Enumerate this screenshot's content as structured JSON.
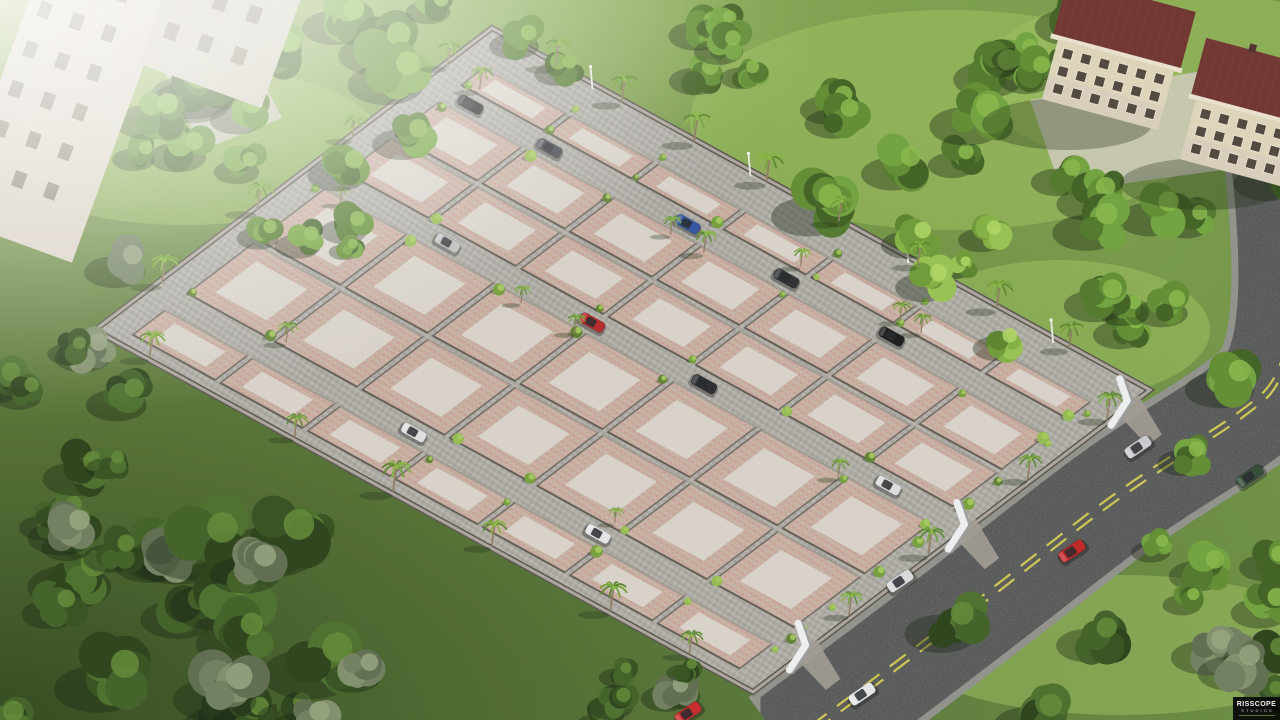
{
  "meta": {
    "type": "3d-aerial-render",
    "subject": "residential plot layout development"
  },
  "watermark": {
    "studio": "RISSCOPE",
    "subtitle": "STUDIOS"
  },
  "palette": {
    "grass": "#6c8f41",
    "grassDark": "#33491d",
    "grassLight": "#9cc05c",
    "plotPaver": [
      "#c9a89d",
      "#bfae9f",
      "#c2a195",
      "#cbb4a6"
    ],
    "plotCenter": "#d8d4cd",
    "roadPaver": [
      "#a8a6a0",
      "#b3b1ab",
      "#9f9d97",
      "#aeaca6"
    ],
    "wallLine": "#6e6963",
    "wallShadow": "#4e4a44",
    "wallLight": "#cfc9c0",
    "boundaryDark": "#55514a",
    "boundaryLight": "#a8a29a",
    "asphalt": "#474849",
    "curb": "#8e8e88",
    "laneLine": "#d8d24e",
    "gateWhite": "#eceef0",
    "gateShadow": "#97999b",
    "roof": "#6b2f2b",
    "roofStripe": "#7b3833",
    "buildingWall": "#dcd3b8",
    "buildingWallShade": "#cfc8ba",
    "windowDark": "#4a4238",
    "windowFrame": "#ece4d0",
    "trunk": "#8a7a5e",
    "haze": "#ffffff"
  },
  "site": {
    "corners": {
      "top": [
        492,
        28
      ],
      "right": [
        1150,
        390
      ],
      "bottom": [
        753,
        692
      ],
      "left": [
        95,
        330
      ]
    },
    "apron_top": 0.08,
    "margin_s": 0.035,
    "margin_bottom": 0.025,
    "roads_t": [
      0.17,
      0.46,
      0.86
    ],
    "road_halfwidth": 0.022,
    "rows_t": [
      [
        0.08,
        0.148
      ],
      [
        0.192,
        0.315
      ],
      [
        0.315,
        0.438
      ],
      [
        0.482,
        0.66
      ],
      [
        0.66,
        0.838
      ],
      [
        0.882,
        0.975
      ]
    ],
    "cols": 7
  },
  "internal_cars": [
    {
      "road_t": 0.17,
      "s": 0.07,
      "color": "#141518"
    },
    {
      "road_t": 0.17,
      "s": 0.19,
      "color": "#3a3e44"
    },
    {
      "road_t": 0.17,
      "s": 0.4,
      "color": "#2d4f9e"
    },
    {
      "road_t": 0.17,
      "s": 0.55,
      "color": "#27292d"
    },
    {
      "road_t": 0.17,
      "s": 0.71,
      "color": "#121316"
    },
    {
      "road_t": 0.46,
      "s": 0.21,
      "color": "#b9bbbd"
    },
    {
      "road_t": 0.46,
      "s": 0.43,
      "color": "#b42222"
    },
    {
      "road_t": 0.46,
      "s": 0.6,
      "color": "#232529"
    },
    {
      "road_t": 0.46,
      "s": 0.88,
      "color": "#d9dbdd"
    },
    {
      "road_t": 0.86,
      "s": 0.4,
      "color": "#dcdee0"
    },
    {
      "road_t": 0.86,
      "s": 0.68,
      "color": "#e1e3e5"
    }
  ],
  "road_cars": [
    {
      "x": 1138,
      "y": 447,
      "color": "#c6c8cc"
    },
    {
      "x": 1250,
      "y": 476,
      "color": "#2c4531"
    },
    {
      "x": 1072,
      "y": 551,
      "color": "#bd1f1f"
    },
    {
      "x": 900,
      "y": 581,
      "color": "#d6d8da"
    },
    {
      "x": 862,
      "y": 694,
      "color": "#e3e5e7"
    },
    {
      "x": 688,
      "y": 713,
      "color": "#c32424"
    }
  ],
  "gates_t": [
    0.05,
    0.46,
    0.86
  ],
  "boundary_palms": {
    "top_right_s": [
      0.1,
      0.2,
      0.31,
      0.42,
      0.53,
      0.65,
      0.77,
      0.88
    ],
    "top_left_t": [
      0.12,
      0.36,
      0.6,
      0.84
    ],
    "bottom_left_s": [
      0.08,
      0.3,
      0.45,
      0.6,
      0.78,
      0.9
    ],
    "bottom_right_t": [
      0.1,
      0.3,
      0.55,
      0.75
    ]
  },
  "lamp_posts_s": [
    0.16,
    0.4,
    0.64,
    0.86
  ],
  "main_road": {
    "center_path": "M 786 748 C 870 686 960 618 1072 530 C 1168 455 1212 440 1262 398 C 1306 360 1296 240 1285 140",
    "width": 112,
    "curb_width": 126,
    "lane_dash": "20 13"
  },
  "buildings": {
    "top_right": [
      {
        "x": 1112,
        "y": 62,
        "rot": 15
      },
      {
        "x": 1250,
        "y": 122,
        "rot": 15
      }
    ],
    "top_left": {
      "x": 60,
      "y": 120,
      "rot": 20
    }
  },
  "tree_regions": [
    {
      "x": 0,
      "y": 530,
      "w": 370,
      "h": 190,
      "count": 24,
      "pal": "dark",
      "rmin": 26,
      "rmax": 52
    },
    {
      "x": 0,
      "y": 230,
      "w": 130,
      "h": 310,
      "count": 11,
      "pal": "dark",
      "rmin": 20,
      "rmax": 38
    },
    {
      "x": 110,
      "y": 0,
      "w": 330,
      "h": 185,
      "count": 13,
      "pal": "mid",
      "rmin": 22,
      "rmax": 44
    },
    {
      "x": 240,
      "y": 150,
      "w": 140,
      "h": 115,
      "count": 5,
      "pal": "mid",
      "rmin": 14,
      "rmax": 26
    },
    {
      "x": 430,
      "y": 0,
      "w": 320,
      "h": 75,
      "count": 8,
      "pal": "mid",
      "rmin": 16,
      "rmax": 30
    },
    {
      "x": 800,
      "y": 10,
      "w": 300,
      "h": 200,
      "count": 13,
      "pal": "mid",
      "rmin": 18,
      "rmax": 40
    },
    {
      "x": 1090,
      "y": 170,
      "w": 190,
      "h": 230,
      "count": 9,
      "pal": "mid",
      "rmin": 20,
      "rmax": 38
    },
    {
      "x": 940,
      "y": 620,
      "w": 340,
      "h": 100,
      "count": 8,
      "pal": "dark",
      "rmin": 22,
      "rmax": 42
    },
    {
      "x": 1150,
      "y": 440,
      "w": 130,
      "h": 190,
      "count": 6,
      "pal": "mid",
      "rmin": 18,
      "rmax": 32
    },
    {
      "x": 560,
      "y": 645,
      "w": 210,
      "h": 75,
      "count": 6,
      "pal": "dark",
      "rmin": 16,
      "rmax": 28
    },
    {
      "x": 850,
      "y": 200,
      "w": 180,
      "h": 160,
      "count": 5,
      "pal": "light",
      "rmin": 16,
      "rmax": 30
    }
  ],
  "lawn_patches": [
    [
      950,
      120,
      260,
      110
    ],
    [
      1180,
      80,
      200,
      90
    ],
    [
      1120,
      645,
      220,
      70
    ],
    [
      185,
      145,
      200,
      80
    ],
    [
      1060,
      330,
      150,
      70
    ]
  ],
  "paved_patches": [
    [
      [
        1030,
        100
      ],
      [
        1280,
        58
      ],
      [
        1280,
        162
      ],
      [
        1062,
        192
      ]
    ],
    [
      [
        150,
        42
      ],
      [
        232,
        20
      ],
      [
        282,
        118
      ],
      [
        202,
        150
      ]
    ]
  ]
}
